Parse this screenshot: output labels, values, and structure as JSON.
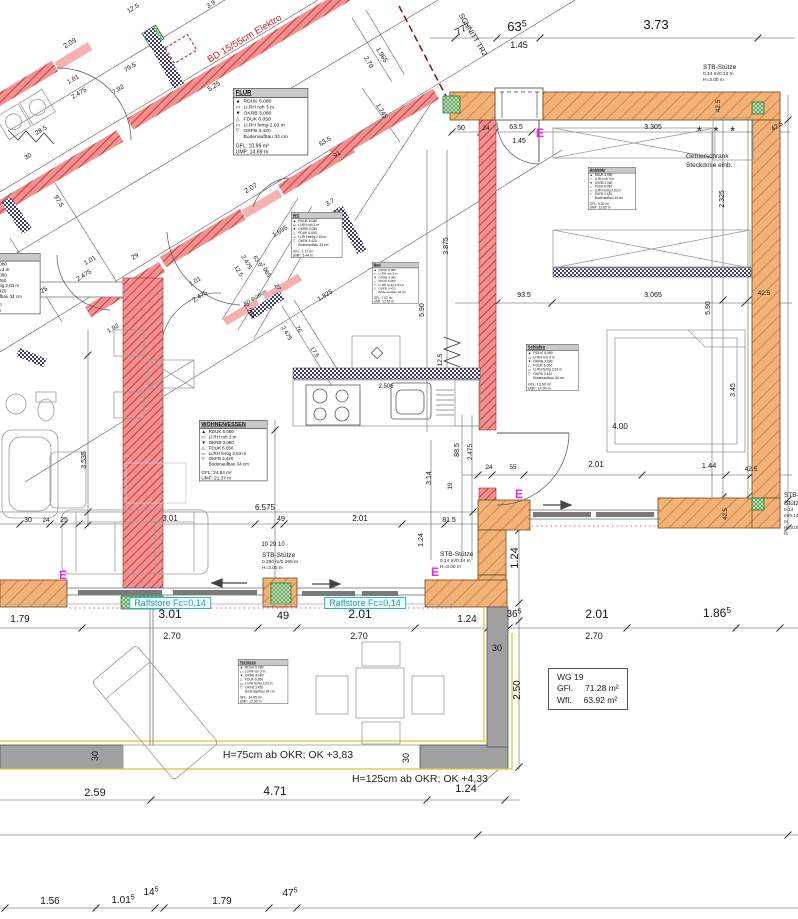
{
  "meta": {
    "type": "architectural-floor-plan",
    "unit_system": "meters"
  },
  "colors": {
    "dim_text": "#151515",
    "red_note": "#cc2222",
    "cyan": "#2d9fa4",
    "magenta": "#f023e6",
    "wall_red": "#f09090",
    "wall_orange": "#f2b176",
    "parapet_gray": "#a0a0a0",
    "yellow_line": "#d8c832"
  },
  "room_lines": [
    "RDUK 6.080",
    "Li.RH roh 3 m",
    "OKRB 3.080",
    "FDUK 6.050",
    "Li.RH fertig 2,63 m",
    "OKFB 3.420",
    "Bodenaufbau 34 cm"
  ],
  "room_line_symbols": [
    "▲",
    "▭",
    "▼",
    "△",
    "▭",
    "▽",
    ""
  ],
  "rooms": [
    {
      "id": "flur",
      "title": "FLUR",
      "gfl": "GFL: 10.99 m²",
      "umf": "UMF: 14.69 m"
    },
    {
      "id": "ankleide",
      "title": "Ankleide",
      "gfl": "GFL: 9.30 m²",
      "umf": "UMF: 12.65 m"
    },
    {
      "id": "bad",
      "title": "Bad",
      "gfl": "GFL: 7.57 m²",
      "umf": "UMF: 12.16 m"
    },
    {
      "id": "wc",
      "title": "WC",
      "gfl": "GFL: 1.72 m²",
      "umf": "UMF: 5.44 m"
    },
    {
      "id": "wohnen",
      "title": "WOHNEN/ESSEN",
      "gfl": "GFL: 24.84 m²",
      "umf": "UMF: 21.37 m"
    },
    {
      "id": "schlafen",
      "title": "Schlafen",
      "gfl": "GFL: 13.60 m²",
      "umf": "UMF: 14.90 m"
    },
    {
      "id": "terrasse",
      "title": "Terrasse",
      "gfl": "GFL: 14.85 m²",
      "umf": "UMF: 17.50 m"
    },
    {
      "id": "cut",
      "title": "",
      "gfl": "GFL: 1.79 m²",
      "umf": "UMF: 2.65 m"
    }
  ],
  "wg_box": {
    "line1": "WG 19",
    "gfl_label": "GFl.",
    "gfl_value": "71.28 m²",
    "wfl_label": "Wfl.",
    "wfl_value": "63.92 m²"
  },
  "raffstore_label": "Raffstore Fc=0,14",
  "stb": {
    "a": [
      "STB-Stütze",
      "0.14 m/0.14 m",
      "H=3.00 m"
    ],
    "b": [
      "STB-Stütze",
      "0.290 m/0.265 m",
      "H=3.00 m"
    ],
    "c": [
      "STB-Stütze",
      "0.14 m/0.14 m",
      "H=3.00 m"
    ],
    "d": [
      "STB-Stütze",
      "0.14 m/0.14 m",
      "H=3.00 m"
    ]
  },
  "notes": {
    "gefrier1": "Gefrierschrank",
    "gefrier2": "Steckdose einb.",
    "h75": "H=75cm ab OKR; OK +3,83",
    "h125": "H=125cm ab OKR; OK +4,33",
    "e_marker": "E",
    "asterisks": "* * *"
  },
  "e_markers": [
    {
      "x": 540,
      "y": 133
    },
    {
      "x": 519,
      "y": 494
    },
    {
      "x": 63,
      "y": 575
    },
    {
      "x": 435,
      "y": 572
    }
  ],
  "dims": [
    {
      "t": "12.5",
      "x": 134,
      "y": 10,
      "r": -31,
      "s": 6.5
    },
    {
      "t": "3.9",
      "x": 212,
      "y": 6,
      "r": -31,
      "s": 6.5
    },
    {
      "t": "2.09",
      "x": 71,
      "y": 45,
      "r": -31,
      "s": 7
    },
    {
      "t": "1.01",
      "x": 74,
      "y": 81,
      "r": -31,
      "s": 6.5
    },
    {
      "t": "2.475",
      "x": 80,
      "y": 95,
      "r": -31,
      "s": 6.5
    },
    {
      "t": "79.5",
      "x": 131,
      "y": 69,
      "r": -31,
      "s": 6.5
    },
    {
      "t": "7.92",
      "x": 119,
      "y": 91,
      "r": -31,
      "s": 6.5
    },
    {
      "t": "5.25",
      "x": 215,
      "y": 88,
      "r": -31,
      "s": 7
    },
    {
      "t": "1.965",
      "x": 380,
      "y": 56,
      "r": 59,
      "s": 6.5
    },
    {
      "t": "2.70",
      "x": 367,
      "y": 63,
      "r": 59,
      "s": 6.5
    },
    {
      "t": "1.245",
      "x": 380,
      "y": 112,
      "r": 59,
      "s": 6.5
    },
    {
      "t": "63.5",
      "x": 326,
      "y": 143,
      "r": -31,
      "s": 6.5
    },
    {
      "t": "91",
      "x": 338,
      "y": 156,
      "r": -31,
      "s": 6.5
    },
    {
      "t": "28.5",
      "x": 42,
      "y": 132,
      "r": -31,
      "s": 6.5
    },
    {
      "t": "30",
      "x": 29,
      "y": 158,
      "r": -31,
      "s": 6.5
    },
    {
      "t": "97.5",
      "x": 57,
      "y": 202,
      "r": 59,
      "s": 6.5
    },
    {
      "t": "2.90",
      "x": 32,
      "y": 267,
      "r": 59,
      "s": 6.5
    },
    {
      "t": "15.25",
      "x": 41,
      "y": 294,
      "r": -31,
      "s": 6.5
    },
    {
      "t": "1.01",
      "x": 91,
      "y": 262,
      "r": -31,
      "s": 6.5
    },
    {
      "t": "2.475",
      "x": 85,
      "y": 277,
      "r": -31,
      "s": 6.5
    },
    {
      "t": "29",
      "x": 136,
      "y": 258,
      "r": -31,
      "s": 6.5
    },
    {
      "t": "1.92",
      "x": 114,
      "y": 330,
      "r": -31,
      "s": 6.5
    },
    {
      "t": "1.01",
      "x": 196,
      "y": 283,
      "r": -31,
      "s": 6.5
    },
    {
      "t": "2.475",
      "x": 201,
      "y": 298,
      "r": -31,
      "s": 6.5
    },
    {
      "t": "2.07",
      "x": 252,
      "y": 190,
      "r": -31,
      "s": 7
    },
    {
      "t": "1.695",
      "x": 281,
      "y": 233,
      "r": -31,
      "s": 6.5
    },
    {
      "t": "3.7",
      "x": 331,
      "y": 204,
      "r": -31,
      "s": 6.5
    },
    {
      "t": "12.5",
      "x": 237,
      "y": 272,
      "r": 59,
      "s": 6
    },
    {
      "t": "2.475",
      "x": 245,
      "y": 263,
      "r": 59,
      "s": 6
    },
    {
      "t": "63.5",
      "x": 256,
      "y": 262,
      "r": 59,
      "s": 6
    },
    {
      "t": "7.065",
      "x": 264,
      "y": 271,
      "r": 59,
      "s": 6
    },
    {
      "t": "27",
      "x": 276,
      "y": 288,
      "r": 59,
      "s": 6
    },
    {
      "t": "2.265",
      "x": 248,
      "y": 312,
      "r": 59,
      "s": 6.5
    },
    {
      "t": "2.475",
      "x": 285,
      "y": 334,
      "r": 59,
      "s": 6
    },
    {
      "t": "76",
      "x": 297,
      "y": 330,
      "r": 59,
      "s": 6
    },
    {
      "t": "17.5",
      "x": 313,
      "y": 353,
      "r": 59,
      "s": 6
    },
    {
      "t": "1.825",
      "x": 326,
      "y": 297,
      "r": -31,
      "s": 6.5
    },
    {
      "t": "BD 8x26cm",
      "x": 256,
      "y": 299,
      "r": -31,
      "s": 5
    },
    {
      "t": "BD 15/55cm Elektro",
      "x": 246,
      "y": 41,
      "r": -31,
      "s": 9.5,
      "c": "red"
    },
    {
      "t": "SCHNITT TR2",
      "x": 471,
      "y": 36,
      "r": 59,
      "s": 7.5
    },
    {
      "t": "77",
      "sup": "5",
      "x": 464,
      "y": 32,
      "r": -31,
      "s": 10
    },
    {
      "t": "63",
      "sup": "5",
      "x": 517,
      "y": 31,
      "s": 13
    },
    {
      "t": "1.45",
      "x": 519,
      "y": 48,
      "s": 9
    },
    {
      "t": "3.73",
      "x": 656,
      "y": 29,
      "s": 13
    },
    {
      "t": "50",
      "x": 461,
      "y": 130,
      "s": 7
    },
    {
      "t": "24",
      "x": 486,
      "y": 130,
      "s": 6.5
    },
    {
      "t": "63.5",
      "x": 516,
      "y": 129,
      "s": 7
    },
    {
      "t": "1.45",
      "x": 519,
      "y": 143,
      "s": 7
    },
    {
      "t": "3.305",
      "x": 653,
      "y": 129,
      "s": 7
    },
    {
      "t": "42.5",
      "x": 778,
      "y": 128,
      "r": -31,
      "s": 6.5
    },
    {
      "t": "42.5",
      "x": 720,
      "y": 106,
      "r": -90,
      "s": 6.5
    },
    {
      "t": "2.325",
      "x": 724,
      "y": 199,
      "r": -90,
      "s": 7
    },
    {
      "t": "5.90",
      "x": 710,
      "y": 308,
      "r": -90,
      "s": 7
    },
    {
      "t": "5.90",
      "x": 424,
      "y": 310,
      "r": -90,
      "s": 7
    },
    {
      "t": "3.875",
      "x": 448,
      "y": 246,
      "r": -90,
      "s": 7
    },
    {
      "t": "12.5",
      "x": 442,
      "y": 360,
      "r": -90,
      "s": 6.5
    },
    {
      "t": "2.506",
      "x": 386,
      "y": 388,
      "s": 6
    },
    {
      "t": "93.5",
      "x": 524,
      "y": 297,
      "s": 7
    },
    {
      "t": "3.065",
      "x": 653,
      "y": 297,
      "s": 7
    },
    {
      "t": "42.5",
      "x": 764,
      "y": 295,
      "s": 6.5
    },
    {
      "t": "3.45",
      "x": 735,
      "y": 390,
      "r": -90,
      "s": 7
    },
    {
      "t": "4.00",
      "x": 620,
      "y": 429,
      "s": 8
    },
    {
      "t": "24",
      "x": 489,
      "y": 469,
      "s": 6.5
    },
    {
      "t": "55",
      "x": 513,
      "y": 469,
      "s": 6.5
    },
    {
      "t": "2.01",
      "x": 596,
      "y": 467,
      "s": 8
    },
    {
      "t": "1.44",
      "x": 709,
      "y": 468,
      "s": 7.5
    },
    {
      "t": "42.5",
      "x": 751,
      "y": 471,
      "s": 6.5
    },
    {
      "t": "42.5",
      "x": 727,
      "y": 514,
      "r": -90,
      "s": 6
    },
    {
      "t": "88.5",
      "x": 459,
      "y": 450,
      "r": -90,
      "s": 7
    },
    {
      "t": "2.475",
      "x": 472,
      "y": 452,
      "r": -90,
      "s": 6.5
    },
    {
      "t": "3.14",
      "x": 431,
      "y": 478,
      "r": -90,
      "s": 7
    },
    {
      "t": "19",
      "x": 452,
      "y": 486,
      "r": -90,
      "s": 6.5
    },
    {
      "t": "81.5",
      "x": 449,
      "y": 522,
      "s": 7
    },
    {
      "t": "1.24",
      "x": 423,
      "y": 540,
      "r": -90,
      "s": 7
    },
    {
      "t": "1.24",
      "x": 518,
      "y": 558,
      "r": -90,
      "s": 11
    },
    {
      "t": "3.535",
      "x": 86,
      "y": 460,
      "r": -90,
      "s": 7
    },
    {
      "t": "30",
      "x": 28,
      "y": 522,
      "s": 7
    },
    {
      "t": "24",
      "x": 46,
      "y": 522,
      "s": 6.5
    },
    {
      "t": "25",
      "x": 64,
      "y": 522,
      "s": 7
    },
    {
      "t": "3.01",
      "x": 170,
      "y": 521,
      "s": 8
    },
    {
      "t": "6.575",
      "x": 265,
      "y": 510,
      "s": 8
    },
    {
      "t": "49",
      "x": 281,
      "y": 521,
      "s": 7
    },
    {
      "t": "2.01",
      "x": 360,
      "y": 521,
      "s": 8
    },
    {
      "t": "10 29 10",
      "x": 273,
      "y": 546,
      "s": 6
    },
    {
      "t": "1.79",
      "x": 20,
      "y": 622,
      "s": 10
    },
    {
      "t": "3.01",
      "x": 170,
      "y": 618,
      "s": 12
    },
    {
      "t": "2.70",
      "x": 172,
      "y": 639,
      "s": 9
    },
    {
      "t": "49",
      "x": 283,
      "y": 619,
      "s": 11
    },
    {
      "t": "2.01",
      "x": 360,
      "y": 618,
      "s": 12
    },
    {
      "t": "2.70",
      "x": 359,
      "y": 639,
      "s": 9
    },
    {
      "t": "1.24",
      "x": 467,
      "y": 622,
      "s": 10
    },
    {
      "t": "36",
      "sup": "5",
      "x": 514,
      "y": 617,
      "s": 10
    },
    {
      "t": "30",
      "x": 497,
      "y": 651,
      "s": 9
    },
    {
      "t": "2.01",
      "x": 597,
      "y": 618,
      "s": 12
    },
    {
      "t": "2.70",
      "x": 594,
      "y": 639,
      "s": 9
    },
    {
      "t": "1.86",
      "sup": "5",
      "x": 717,
      "y": 617,
      "s": 12
    },
    {
      "t": "2.50",
      "x": 520,
      "y": 690,
      "r": -90,
      "s": 10
    },
    {
      "t": "2.59",
      "x": 95,
      "y": 796,
      "s": 11
    },
    {
      "t": "4.71",
      "x": 275,
      "y": 795,
      "s": 12
    },
    {
      "t": "1.24",
      "x": 466,
      "y": 792,
      "s": 11
    },
    {
      "t": "30",
      "x": 98,
      "y": 756,
      "r": -90,
      "s": 9
    },
    {
      "t": "30",
      "x": 409,
      "y": 758,
      "r": -90,
      "s": 9
    },
    {
      "t": "1.56",
      "x": 50,
      "y": 904,
      "s": 10
    },
    {
      "t": "1.01",
      "sup": "5",
      "x": 123,
      "y": 903,
      "s": 10
    },
    {
      "t": "14",
      "sup": "5",
      "x": 151,
      "y": 895,
      "s": 10
    },
    {
      "t": "1.79",
      "x": 222,
      "y": 904,
      "s": 10
    },
    {
      "t": "47",
      "sup": "5",
      "x": 290,
      "y": 896,
      "s": 10
    }
  ]
}
